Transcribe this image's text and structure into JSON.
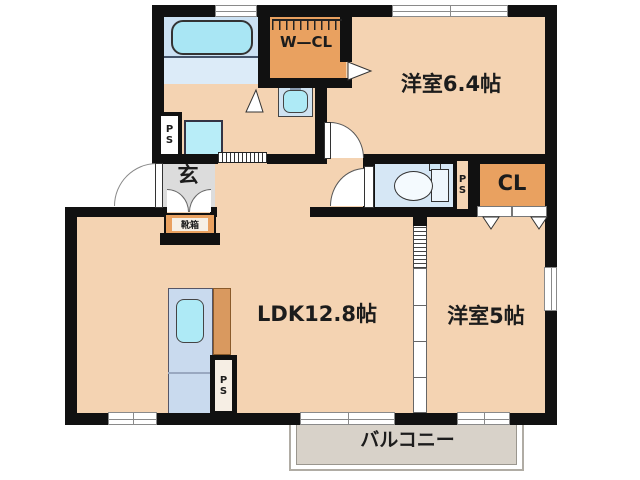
{
  "plan": {
    "type": "japanese-apartment-floor-plan",
    "rooms": {
      "west_room_64": {
        "label": "洋室6.4帖"
      },
      "west_room_5": {
        "label": "洋室5帖"
      },
      "ldk": {
        "label": "LDK12.8帖"
      },
      "genkan": {
        "label": "玄"
      },
      "balcony": {
        "label": "バルコニー"
      },
      "walk_in_closet": {
        "label": "W—CL"
      },
      "closet": {
        "label": "CL"
      },
      "shoe_cabinet": {
        "label": "靴箱"
      },
      "pipe_space": {
        "label": "PS"
      }
    },
    "fixtures": [
      "bathtub",
      "washbasin",
      "washing-machine-pan",
      "toilet",
      "kitchen-sink",
      "hanger-rail"
    ],
    "colors": {
      "wall": "#111111",
      "room_floor": "#f4d3b2",
      "closet_orange": "#e9a160",
      "kitchen_counter_orange": "#d9995f",
      "bath_floor_upper": "#cbe1f3",
      "bath_floor_lower": "#dcebf8",
      "fixture_cyan": "#aeeaf6",
      "kitchen_unit_blue": "#c9daee",
      "toilet_floor_blue": "#d6e7f5",
      "genkan_gray": "#dcdcdc",
      "balcony_gray": "#d8d2c9"
    }
  }
}
